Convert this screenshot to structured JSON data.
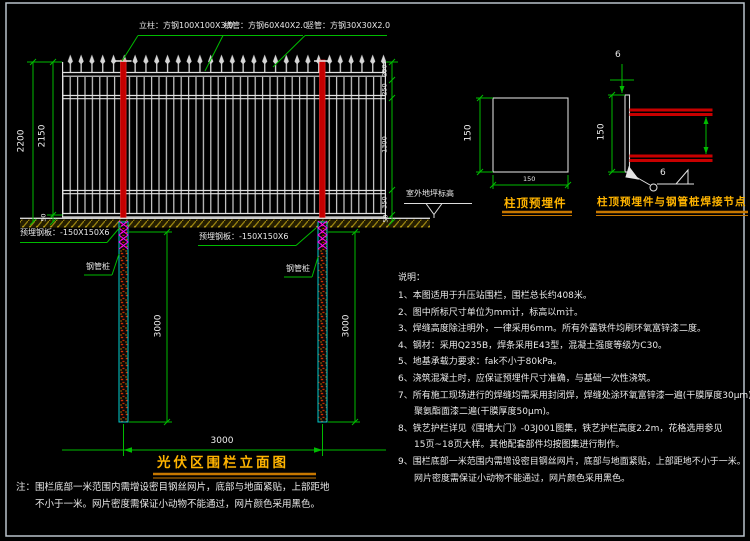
{
  "colors": {
    "line_green": "#00bb00",
    "steel_white": "#d9d9d9",
    "post_red": "#d40000",
    "pile_cyan": "#00cccc",
    "connector_magenta": "#ff00ff",
    "title_yellow": "#ffb400",
    "underline_orange": "#c77700",
    "ground_olive": "#9a8410",
    "weld_red": "#c80000"
  },
  "elevation": {
    "callouts": {
      "post": "立柱：方钢100X100X3.0",
      "rail": "横管：方钢60X40X2.0",
      "picket": "竖管：方钢30X30X2.0",
      "plate_left": "预埋钢板：-150X150X6",
      "plate_mid": "预埋钢板：-150X150X6",
      "pile_left": "钢管桩",
      "pile_right": "钢管桩",
      "ground": "室外地坪标高"
    },
    "dims": {
      "overall_height": "2200",
      "panel_height": "2150",
      "bottom_gap": "50",
      "right_chain": [
        "250",
        "250",
        "1300",
        "350",
        "50"
      ],
      "pile_depth_left": "3000",
      "pile_depth_right": "3000",
      "pile_spacing": "3000"
    },
    "title": "光伏区围栏立面图",
    "note1": "注：围栏底部一米范围内需增设密目钢丝网片，底部与地面紧贴，上部距地",
    "note2": "不小于一米。网片密度需保证小动物不能通过，网片颜色采用黑色。"
  },
  "detail_plate": {
    "title": "柱顶预埋件",
    "height": "150",
    "width": "150"
  },
  "detail_weld": {
    "title": "柱顶预埋件与钢管桩焊接节点",
    "height": "150",
    "weld_size_top": "6",
    "weld_size_bottom": "6"
  },
  "notes": {
    "heading": "说明：",
    "lines": [
      "1、本图适用于升压站围栏，围栏总长约408米。",
      "2、图中所标尺寸单位为mm计，标高以m计。",
      "3、焊缝高度除注明外，一律采用6mm。所有外露铁件均刷环氧富锌漆二度。",
      "4、钢材：采用Q235B，焊条采用E43型，混凝土强度等级为C30。",
      "5、地基承载力要求：fak不小于80kPa。",
      "6、浇筑混凝土时，应保证预埋件尺寸准确，与基础一次性浇筑。",
      "7、所有施工现场进行的焊缝均需采用封闭焊，焊缝处涂环氧富锌漆一遍(干膜厚度30μm)，",
      "聚氨酯面漆二遍(干膜厚度50μm)。",
      "8、铁艺护栏详见《围墙大门》-03J001图集，铁艺护栏高度2.2m，花格选用参见",
      "15页~18页大样。其他配套部件均按图集进行制作。",
      "9、围栏底部一米范围内需增设密目钢丝网片，底部与地面紧贴，上部距地不小于一米。",
      "网片密度需保证小动物不能通过，网片颜色采用黑色。"
    ]
  }
}
